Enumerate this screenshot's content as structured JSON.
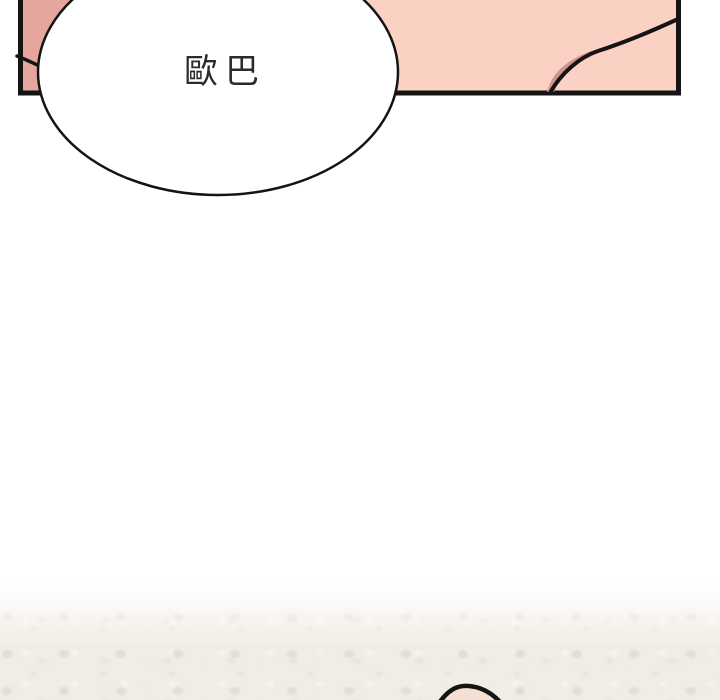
{
  "scene": {
    "type": "webtoon-comic-panel",
    "speech_bubble": {
      "text": "歐巴"
    },
    "colors": {
      "panel_fill": "#fbd1c3",
      "panel_shade": "#e5a79d",
      "contour_shadow": "#d39190",
      "outline": "#141414",
      "bubble_fill": "#ffffff",
      "text_color": "#2b2b2b",
      "texture_base": "#f1ede6",
      "texture_speckle": "#e3ded4",
      "bump_fill": "#f5ded2",
      "background": "#ffffff"
    }
  }
}
